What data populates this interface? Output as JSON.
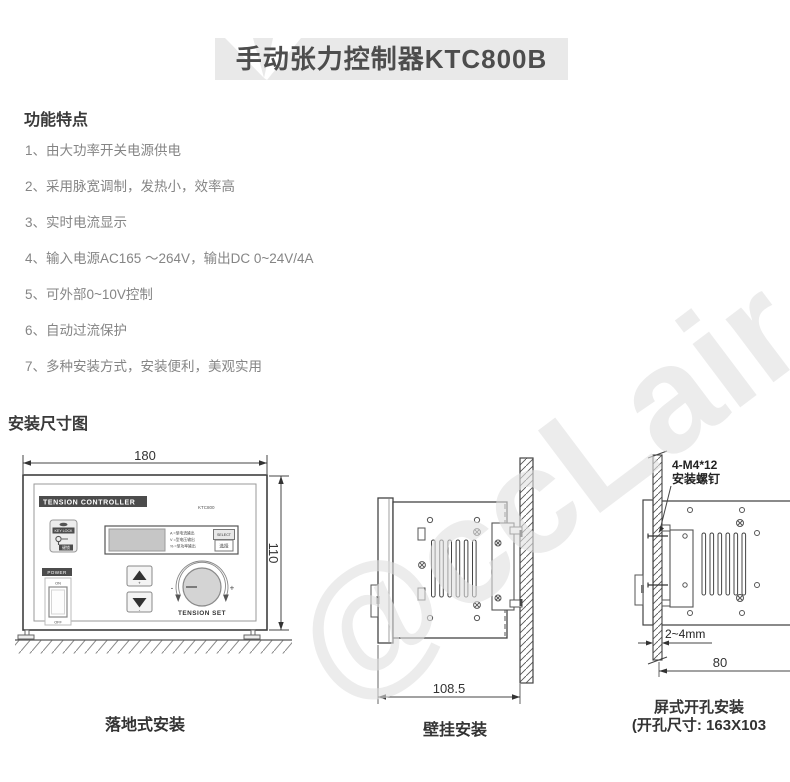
{
  "title": "手动张力控制器KTC800B",
  "features": {
    "heading": "功能特点",
    "items": [
      "1、由大功率开关电源供电",
      "2、采用脉宽调制，发热小，效率高",
      "3、实时电流显示",
      "4、输入电源AC165 ～264V，输出DC 0~24V/4A",
      "5、可外部0~10V控制",
      "6、自动过流保护",
      "7、多种安装方式，安装便利，美观实用"
    ]
  },
  "install": {
    "heading": "安装尺寸图",
    "floor": {
      "caption": "落地式安装",
      "width_dim": "180",
      "height_dim": "110",
      "panel": {
        "title": "TENSION CONTROLLER",
        "model": "KTC800",
        "keylock_label": "KEY LOCK",
        "keylock_cn": "键锁",
        "power_label": "POWER",
        "power_on": "ON",
        "power_off": "OFF",
        "display_line_a": "A =型电流输出",
        "display_line_v": "V =型电压输出",
        "display_line_p": "% =型功率输出",
        "select_label": "SELECT",
        "select_cn": "选择",
        "knob_label": "TENSION SET",
        "minus": "-",
        "plus": "+",
        "btn_plus": "+",
        "btn_minus": "-"
      }
    },
    "wall": {
      "caption": "壁挂安装",
      "depth_dim": "108.5"
    },
    "panel_mount": {
      "caption_line1": "屏式开孔安装",
      "caption_line2": "(开孔尺寸: 163X103",
      "screw_label_line1": "4-M4*12",
      "screw_label_line2": "安装螺钉",
      "thickness_dim": "2~4mm",
      "depth_dim": "80"
    }
  },
  "watermark": "@ccLair"
}
